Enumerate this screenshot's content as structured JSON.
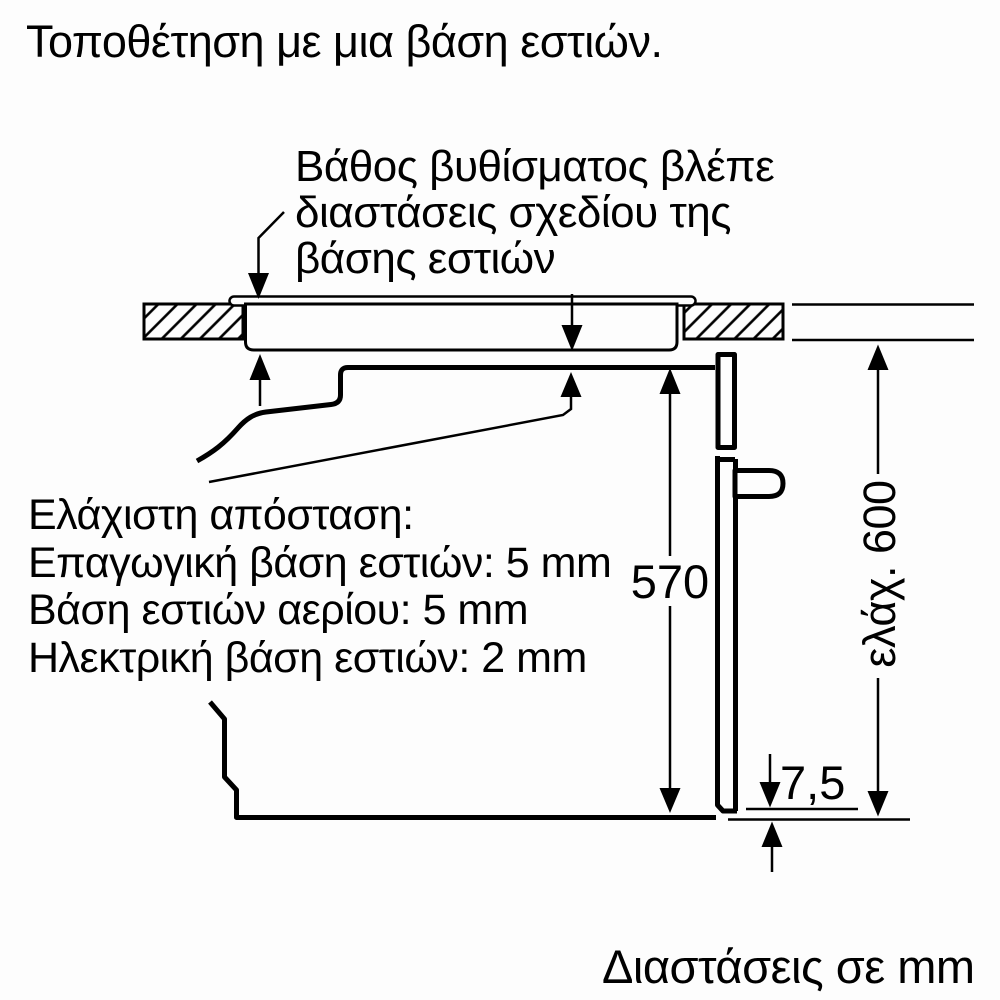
{
  "title": "Τοποθέτηση με μια βάση εστιών.",
  "annotation": {
    "line1": "Βάθος βυθίσματος βλέπε",
    "line2": "διαστάσεις σχεδίου της",
    "line3": "βάσης εστιών"
  },
  "min_distance": {
    "heading": "Ελάχιστη απόσταση:",
    "induction": "Επαγωγική βάση εστιών: 5 mm",
    "gas": "Βάση εστιών αερίου: 5 mm",
    "electric": "Ηλεκτρική βάση εστιών: 2 mm"
  },
  "dimensions": {
    "oven_height": "570",
    "niche_height": "ελάχ. 600",
    "bottom_gap": "7,5"
  },
  "footer": "Διαστάσεις σε mm",
  "colors": {
    "line": "#000000",
    "background": "#fdfdfd"
  }
}
